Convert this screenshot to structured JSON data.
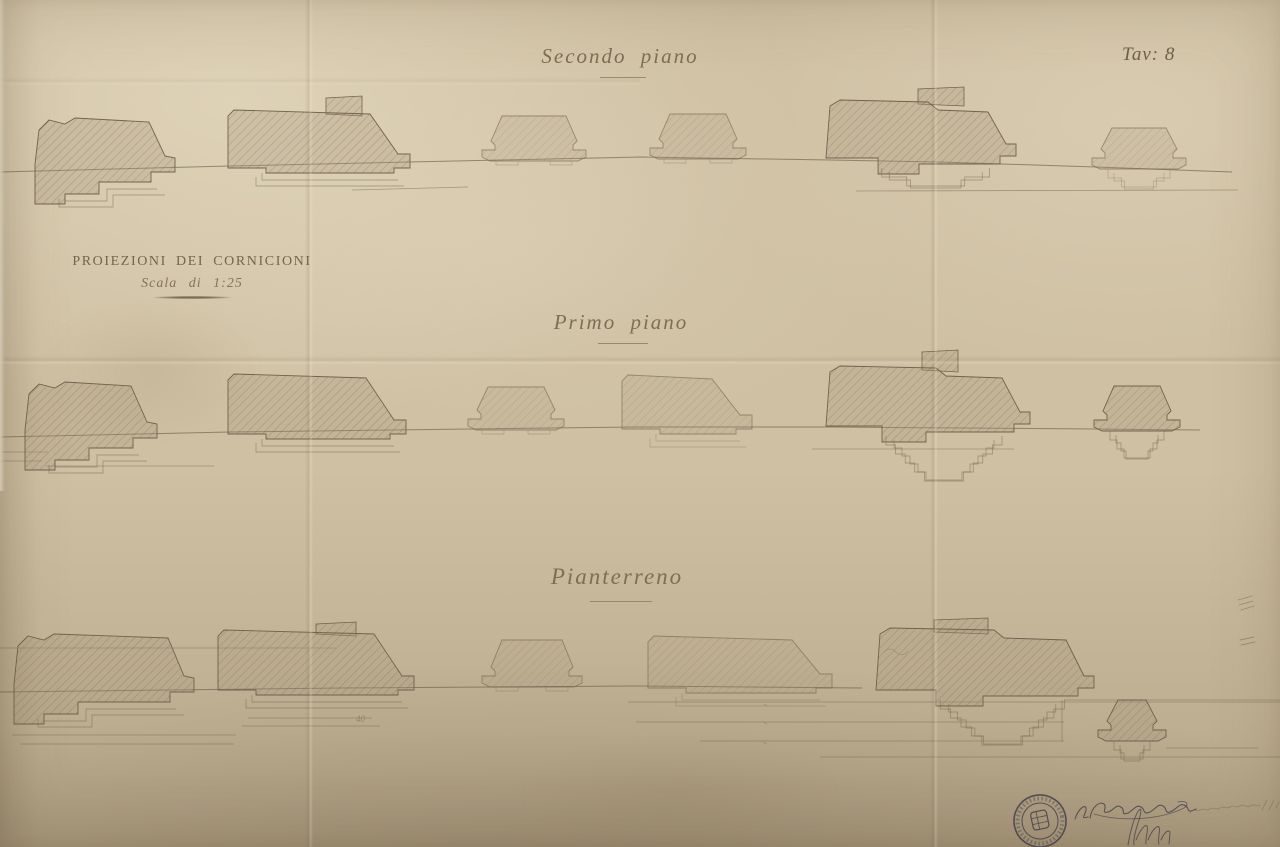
{
  "plate": {
    "label": "Tav: 8"
  },
  "title_block": {
    "title": "PROIEZIONI DEI CORNICIONI",
    "scale": "Scala di 1:25"
  },
  "sections": [
    {
      "label": "Secondo piano"
    },
    {
      "label": "Primo piano"
    },
    {
      "label": "Pianterreno"
    }
  ],
  "annotations": {
    "pencil_note": "40"
  },
  "colors": {
    "paper": "#cfc0a3",
    "ink_line": "#6b5e4b",
    "script_ink": "#7e6e54",
    "stamp_ink": "#3d3b49",
    "pencil": "#8a7c64"
  },
  "drawing": {
    "stroke": "#6b5e4b",
    "hatch_base": "rgba(164,150,121,0.30)",
    "hatch_line": "rgba(106,94,74,0.40)",
    "bands": [
      {
        "name": "secondo-piano",
        "datum": [
          [
            0,
            172
          ],
          [
            230,
            166
          ],
          [
            500,
            160
          ],
          [
            640,
            157
          ],
          [
            830,
            160
          ],
          [
            940,
            162
          ],
          [
            1096,
            167
          ],
          [
            1232,
            172
          ]
        ],
        "lines": [
          [
            856,
            191,
            1238,
            190
          ],
          [
            352,
            190,
            468,
            187
          ]
        ],
        "clusters": [
          {
            "type": "ragged",
            "x": 35,
            "w": 140,
            "h": 52,
            "d": 170
          },
          {
            "type": "trapr",
            "x": 228,
            "w": 186,
            "h": 56,
            "d": 166,
            "tower": {
              "x": 326,
              "w": 36,
              "rise": 16
            }
          },
          {
            "type": "sym",
            "x": 482,
            "w": 104,
            "h": 44,
            "d": 160,
            "light": true
          },
          {
            "type": "sym",
            "x": 650,
            "w": 96,
            "h": 44,
            "d": 158,
            "light": true
          },
          {
            "type": "complex",
            "x": 826,
            "w": 186,
            "h": 60,
            "d": 160,
            "tower": {
              "x": 918,
              "w": 46,
              "rise": 15
            },
            "levels": 2
          },
          {
            "type": "smallsym",
            "x": 1092,
            "w": 94,
            "h": 40,
            "d": 168,
            "levels": 2,
            "light": true
          }
        ]
      },
      {
        "name": "primo-piano",
        "datum": [
          [
            0,
            437
          ],
          [
            230,
            432
          ],
          [
            470,
            429
          ],
          [
            640,
            427
          ],
          [
            830,
            427
          ],
          [
            1096,
            429
          ],
          [
            1200,
            430
          ]
        ],
        "lines": [
          [
            0,
            452,
            48,
            452
          ],
          [
            0,
            461,
            42,
            461
          ],
          [
            812,
            449,
            1014,
            449
          ],
          [
            46,
            466,
            214,
            466
          ]
        ],
        "clusters": [
          {
            "type": "ragged",
            "x": 25,
            "w": 132,
            "h": 54,
            "d": 436
          },
          {
            "type": "trapr",
            "x": 228,
            "w": 182,
            "h": 58,
            "d": 432
          },
          {
            "type": "sym",
            "x": 468,
            "w": 96,
            "h": 42,
            "d": 429,
            "light": true
          },
          {
            "type": "trapr",
            "x": 622,
            "w": 134,
            "h": 52,
            "d": 427,
            "light": true
          },
          {
            "type": "complex",
            "x": 826,
            "w": 200,
            "h": 62,
            "d": 428,
            "tower": {
              "x": 922,
              "w": 36,
              "rise": 18
            },
            "levels": 5
          },
          {
            "type": "smallsym",
            "x": 1094,
            "w": 86,
            "h": 44,
            "d": 430,
            "levels": 3
          }
        ]
      },
      {
        "name": "pianterreno",
        "datum": [
          [
            0,
            692
          ],
          [
            340,
            688
          ],
          [
            640,
            686
          ],
          [
            862,
            688
          ]
        ],
        "lines": [
          [
            0,
            648,
            336,
            648
          ],
          [
            628,
            702,
            1280,
            702
          ],
          [
            636,
            722,
            1064,
            722
          ],
          [
            700,
            741,
            1064,
            741
          ],
          [
            820,
            757,
            1280,
            757
          ],
          [
            1064,
            700,
            1280,
            700
          ],
          [
            1062,
            700,
            1062,
            741
          ],
          [
            248,
            718,
            372,
            718
          ],
          [
            242,
            726,
            380,
            726
          ],
          [
            12,
            735,
            236,
            735
          ],
          [
            20,
            744,
            234,
            744
          ],
          [
            1166,
            748,
            1258,
            748
          ]
        ],
        "clusters": [
          {
            "type": "ragged",
            "x": 14,
            "w": 180,
            "h": 56,
            "d": 690
          },
          {
            "type": "trapr",
            "x": 218,
            "w": 200,
            "h": 58,
            "d": 688,
            "tower": {
              "x": 316,
              "w": 40,
              "rise": 10
            }
          },
          {
            "type": "sym",
            "x": 482,
            "w": 100,
            "h": 46,
            "d": 686,
            "light": true
          },
          {
            "type": "trapr",
            "x": 648,
            "w": 188,
            "h": 50,
            "d": 686,
            "light": true
          },
          {
            "type": "complex",
            "x": 876,
            "w": 214,
            "h": 64,
            "d": 692,
            "tower": {
              "x": 934,
              "w": 54,
              "rise": 12
            },
            "levels": 5
          },
          {
            "type": "smallsym",
            "x": 1098,
            "w": 68,
            "h": 40,
            "d": 740,
            "levels": 2
          }
        ]
      }
    ],
    "scribbles": [
      {
        "d": "M1238,600 l14,-4 m-13,9 l14,-4 m-12,9 l13,-4",
        "color": "#8a7c64",
        "w": 0.9,
        "o": 0.7,
        "name": "margin-pencil-marks"
      },
      {
        "d": "M1240,640 l14,-3 m-13,8 l14,-3",
        "color": "#8a7c64",
        "w": 0.9,
        "o": 0.7,
        "name": "margin-pencil-marks"
      },
      {
        "d": "M884,652 q6,-6 12,0 q6,6 12,-1",
        "color": "#8a7c64",
        "w": 0.8,
        "o": 0.6,
        "name": "pencil-scribble"
      },
      {
        "d": "M764,704 l3,2 m-3,16 l3,2 m-4,18 l4,2",
        "color": "#8a7c64",
        "w": 0.8,
        "o": 0.6,
        "name": "tiny-dimension-marks"
      }
    ],
    "stamp": {
      "cx": 1040,
      "cy": 821,
      "color": "#3d3b49"
    },
    "signatures": [
      {
        "name": "signature-ink",
        "color": "#4a4550",
        "w": 1.1,
        "o": 0.85,
        "d": "M1075,819 C1079,807 1087,803 1086,810 C1085,816 1080,819 1088,817 M1090,818 C1092,806 1100,801 1104,804 C1108,807 1100,814 1108,812 C1114,810 1116,804 1121,807 C1126,810 1120,816 1128,813 C1134,810 1136,804 1141,807 C1146,810 1142,815 1150,812 C1156,809 1158,803 1163,806 C1168,809 1164,815 1172,811 C1178,808 1180,802 1186,806 C1190,809 1186,814 1196,809"
      },
      {
        "name": "signature-flourish",
        "color": "#4a4550",
        "w": 0.9,
        "o": 0.7,
        "d": "M1094,814 C1120,822 1160,820 1184,808 C1190,804 1186,800 1178,802"
      },
      {
        "name": "signature-ink-2",
        "color": "#4a4550",
        "w": 1.0,
        "o": 0.8,
        "d": "M1128,845 C1130,831 1135,815 1139,810 C1142,807 1141,813 1139,820 C1135,832 1133,840 1134,845 M1136,840 C1140,830 1145,824 1147,826 C1149,829 1145,838 1146,844 M1148,840 C1152,830 1157,825 1159,827 C1161,830 1157,839 1159,844 M1161,840 C1164,833 1168,829 1170,832 L1169,844"
      },
      {
        "name": "pencil-countersign",
        "color": "#8a7c64",
        "w": 0.8,
        "o": 0.8,
        "d": "M1190,813 C1194,808 1197,812 1200,810 C1204,807 1206,812 1210,809 C1214,806 1216,811 1220,808 C1224,805 1226,810 1230,807 C1234,804 1236,809 1240,806 C1244,803 1246,808 1250,806 C1254,803 1256,807 1260,805 M1262,810 L1267,800 M1269,810 L1274,800 M1276,808 L1279,802"
      }
    ]
  }
}
